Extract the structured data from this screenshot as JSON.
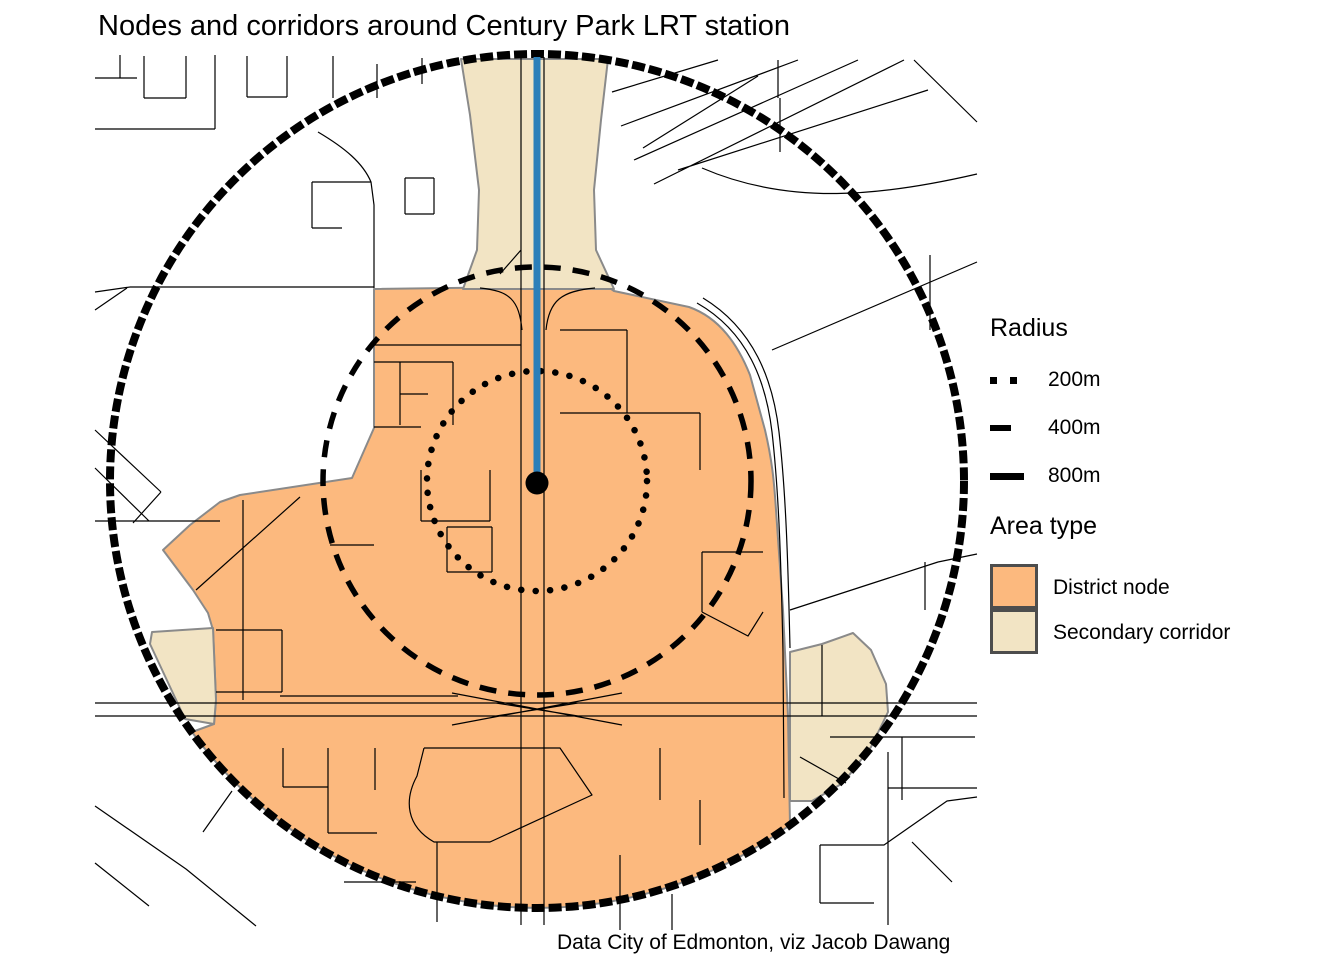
{
  "title": "Nodes and corridors around Century Park LRT station",
  "caption": "Data City of Edmonton, viz Jacob Dawang",
  "legend": {
    "radius_title": "Radius",
    "radius_items": [
      {
        "label": "200m",
        "line_style": "dotted",
        "radius_m": 200
      },
      {
        "label": "400m",
        "line_style": "dashed",
        "radius_m": 400
      },
      {
        "label": "800m",
        "line_style": "solid",
        "radius_m": 800
      }
    ],
    "area_title": "Area type",
    "area_items": [
      {
        "label": "District node"
      },
      {
        "label": "Secondary corridor"
      }
    ]
  },
  "map": {
    "station_marker": "LRT station point",
    "lrt_line": "LRT track",
    "radii_m": [
      200,
      400,
      800
    ]
  },
  "colors": {
    "district_node": "#FCB97E",
    "secondary_corridor": "#F2E4C4",
    "lrt_line": "#2B7FB9",
    "map_lines": "#000000",
    "area_outline": "#8A8A8A",
    "legend_swatch_border": "#4D4D4D"
  }
}
